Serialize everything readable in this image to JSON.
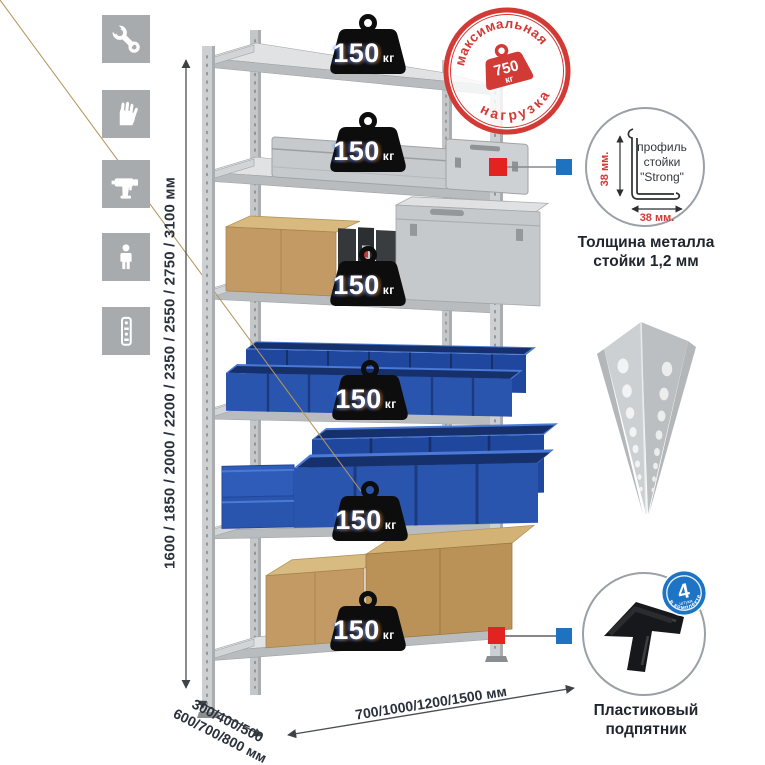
{
  "colors": {
    "accent_red": "#d23a36",
    "connector_red": "#e32222",
    "connector_blue": "#1d73c1",
    "bin_blue": "#2a55ae",
    "metal_gray": "#cdd0d2",
    "tile_gray": "#a7abae"
  },
  "icons": {
    "items": [
      "wrench",
      "gloves",
      "drill",
      "person",
      "rack-post"
    ]
  },
  "dimensions": {
    "height": "1600 / 1850 / 2000 / 2200 / 2350 / 2550 / 2750 / 3100 мм",
    "depth_line1": "300/400/500",
    "depth_line2": "600/700/800 мм",
    "width": "700/1000/1200/1500 мм"
  },
  "shelves": {
    "unit": "кг",
    "loads": [
      "150",
      "150",
      "150",
      "150",
      "150",
      "150"
    ]
  },
  "stamp": {
    "arc_top": "максимальная",
    "arc_bottom": "нагрузка",
    "value": "750",
    "unit": "кг"
  },
  "profile_callout": {
    "line1": "профиль",
    "line2": "стойки",
    "line3": "\"Strong\"",
    "dim_vertical": "38 мм.",
    "dim_horizontal": "38 мм.",
    "caption_line1": "Толщина металла",
    "caption_line2": "стойки 1,2 мм"
  },
  "foot_callout": {
    "badge_value": "4",
    "badge_sub": "штуки",
    "badge_arc": "в комплекте",
    "caption_line1": "Пластиковый",
    "caption_line2": "подпятник"
  }
}
